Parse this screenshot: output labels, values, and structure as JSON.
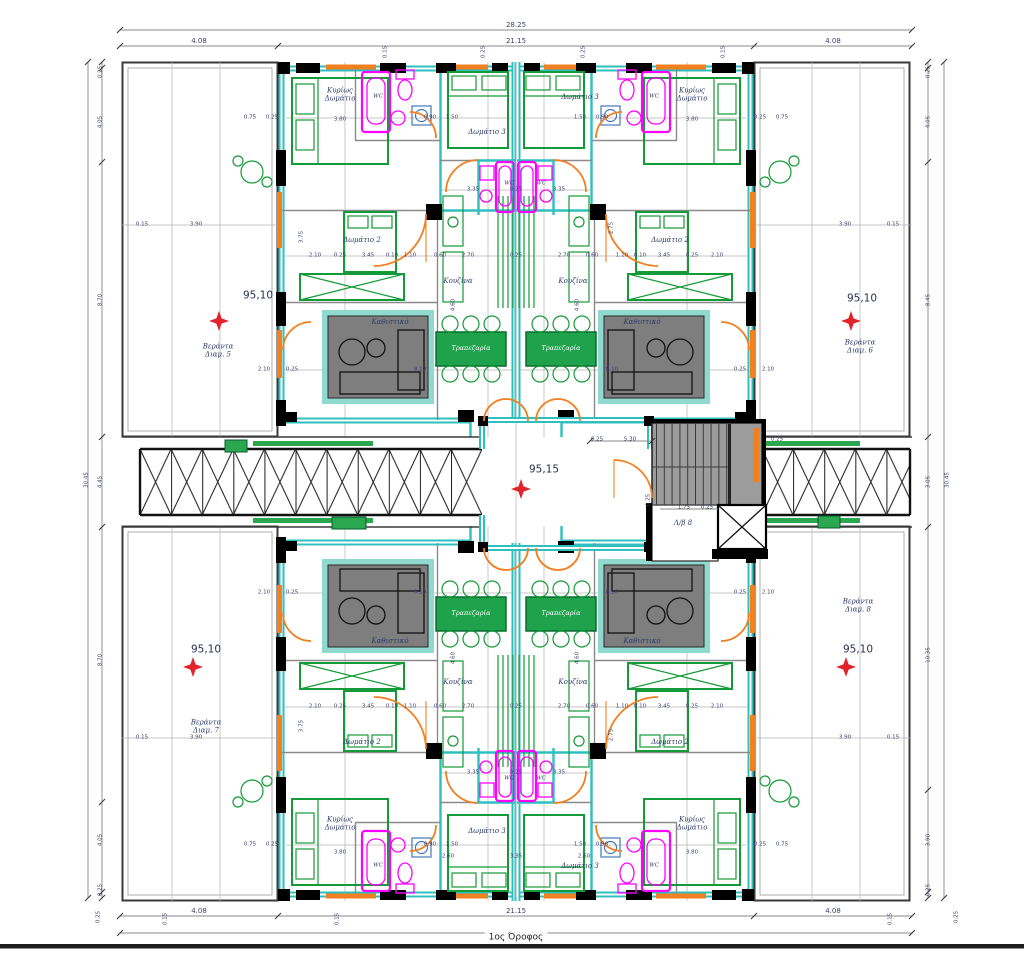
{
  "drawing": {
    "title": "1ος Όροφος"
  },
  "colors": {
    "wall_cyan": "#2FBFBF",
    "furniture_green": "#149A38",
    "dining_fill": "#1FA24C",
    "fixture_magenta": "#FF00FF",
    "door_orange": "#F08020",
    "level_marker_red": "#E3232B",
    "sofa_gray": "#7E7E7E",
    "slab_teal": "#8FD9CE",
    "stair_gray": "#9C9C9C"
  },
  "texts": [
    {
      "t": "95,10",
      "x": 258,
      "y": 296,
      "c": "level"
    },
    {
      "t": "95,10",
      "x": 862,
      "y": 299,
      "c": "level"
    },
    {
      "t": "95,10",
      "x": 206,
      "y": 650,
      "c": "level"
    },
    {
      "t": "95,10",
      "x": 858,
      "y": 650,
      "c": "level"
    },
    {
      "t": "95,15",
      "x": 544,
      "y": 470,
      "c": "level"
    },
    {
      "t": "Κυρίως\nΔωμάτιο",
      "x": 340,
      "y": 95,
      "c": "room"
    },
    {
      "t": "Κυρίως\nΔωμάτιο",
      "x": 692,
      "y": 95,
      "c": "room"
    },
    {
      "t": "Κυρίως\nΔωμάτιο",
      "x": 340,
      "y": 824,
      "c": "room"
    },
    {
      "t": "Κυρίως\nΔωμάτιο",
      "x": 692,
      "y": 824,
      "c": "room"
    },
    {
      "t": "Δωμάτιο 2",
      "x": 362,
      "y": 240,
      "c": "room"
    },
    {
      "t": "Δωμάτιο 2",
      "x": 670,
      "y": 240,
      "c": "room"
    },
    {
      "t": "Δωμάτιο 2",
      "x": 362,
      "y": 742,
      "c": "room"
    },
    {
      "t": "Δωμάτιο 2",
      "x": 670,
      "y": 742,
      "c": "room"
    },
    {
      "t": "Δωμάτιο 3",
      "x": 487,
      "y": 132,
      "c": "room"
    },
    {
      "t": "Δωμάτιο 3",
      "x": 580,
      "y": 97,
      "c": "room"
    },
    {
      "t": "Δωμάτιο 3",
      "x": 487,
      "y": 831,
      "c": "room"
    },
    {
      "t": "Δωμάτιο 3",
      "x": 580,
      "y": 866,
      "c": "room"
    },
    {
      "t": "Κουζίνα",
      "x": 458,
      "y": 281,
      "c": "room"
    },
    {
      "t": "Κουζίνα",
      "x": 573,
      "y": 281,
      "c": "room"
    },
    {
      "t": "Κουζίνα",
      "x": 458,
      "y": 682,
      "c": "room"
    },
    {
      "t": "Κουζίνα",
      "x": 573,
      "y": 682,
      "c": "room"
    },
    {
      "t": "Καθιστικό",
      "x": 390,
      "y": 322,
      "c": "room"
    },
    {
      "t": "Καθιστικό",
      "x": 642,
      "y": 322,
      "c": "room"
    },
    {
      "t": "Καθιστικό",
      "x": 390,
      "y": 641,
      "c": "room"
    },
    {
      "t": "Καθιστικό",
      "x": 642,
      "y": 641,
      "c": "room"
    },
    {
      "t": "Βεράντα\nΔιαμ. 5",
      "x": 218,
      "y": 351,
      "c": "room"
    },
    {
      "t": "Βεράντα\nΔιαμ. 6",
      "x": 860,
      "y": 347,
      "c": "room"
    },
    {
      "t": "Βεράντα\nΔιαμ. 7",
      "x": 206,
      "y": 727,
      "c": "room"
    },
    {
      "t": "Βεράντα\nΔιαμ. 8",
      "x": 858,
      "y": 606,
      "c": "room"
    },
    {
      "t": "Λ/β 8",
      "x": 683,
      "y": 523,
      "c": "room"
    },
    {
      "t": "Τραπεζαρία",
      "x": 471,
      "y": 349,
      "c": "dining"
    },
    {
      "t": "Τραπεζαρία",
      "x": 561,
      "y": 349,
      "c": "dining"
    },
    {
      "t": "Τραπεζαρία",
      "x": 471,
      "y": 614,
      "c": "dining"
    },
    {
      "t": "Τραπεζαρία",
      "x": 561,
      "y": 614,
      "c": "dining"
    },
    {
      "t": "WC",
      "x": 509,
      "y": 184,
      "c": "wc"
    },
    {
      "t": "WC",
      "x": 541,
      "y": 184,
      "c": "wc"
    },
    {
      "t": "WC",
      "x": 509,
      "y": 779,
      "c": "wc"
    },
    {
      "t": "WC",
      "x": 541,
      "y": 779,
      "c": "wc"
    },
    {
      "t": "WC",
      "x": 378,
      "y": 97,
      "c": "wc"
    },
    {
      "t": "WC",
      "x": 654,
      "y": 97,
      "c": "wc"
    },
    {
      "t": "WC",
      "x": 378,
      "y": 866,
      "c": "wc"
    },
    {
      "t": "WC",
      "x": 654,
      "y": 866,
      "c": "wc"
    },
    {
      "t": "28.25",
      "x": 516,
      "y": 25,
      "c": "dimL"
    },
    {
      "t": "4.08",
      "x": 199,
      "y": 41,
      "c": "dimL"
    },
    {
      "t": "21.15",
      "x": 516,
      "y": 41,
      "c": "dimL"
    },
    {
      "t": "4.08",
      "x": 833,
      "y": 41,
      "c": "dimL"
    },
    {
      "t": "4.08",
      "x": 199,
      "y": 911,
      "c": "dimL"
    },
    {
      "t": "21.15",
      "x": 516,
      "y": 911,
      "c": "dimL"
    },
    {
      "t": "4.08",
      "x": 833,
      "y": 911,
      "c": "dimL"
    },
    {
      "t": "30.45",
      "x": 87,
      "y": 480,
      "c": "dim",
      "r": 1
    },
    {
      "t": "0.25",
      "x": 101,
      "y": 72,
      "c": "dim",
      "r": 1
    },
    {
      "t": "4.05",
      "x": 101,
      "y": 122,
      "c": "dim",
      "r": 1
    },
    {
      "t": "8.70",
      "x": 101,
      "y": 300,
      "c": "dim",
      "r": 1
    },
    {
      "t": "4.45",
      "x": 101,
      "y": 482,
      "c": "dim",
      "r": 1
    },
    {
      "t": "8.70",
      "x": 101,
      "y": 660,
      "c": "dim",
      "r": 1
    },
    {
      "t": "4.05",
      "x": 101,
      "y": 840,
      "c": "dim",
      "r": 1
    },
    {
      "t": "0.25",
      "x": 101,
      "y": 890,
      "c": "dim",
      "r": 1
    },
    {
      "t": "30.45",
      "x": 948,
      "y": 480,
      "c": "dim",
      "r": 1
    },
    {
      "t": "0.25",
      "x": 929,
      "y": 72,
      "c": "dim",
      "r": 1
    },
    {
      "t": "4.05",
      "x": 929,
      "y": 122,
      "c": "dim",
      "r": 1
    },
    {
      "t": "8.45",
      "x": 929,
      "y": 300,
      "c": "dim",
      "r": 1
    },
    {
      "t": "3.05",
      "x": 929,
      "y": 482,
      "c": "dim",
      "r": 1
    },
    {
      "t": "10.35",
      "x": 929,
      "y": 655,
      "c": "dim",
      "r": 1
    },
    {
      "t": "3.90",
      "x": 929,
      "y": 840,
      "c": "dim",
      "r": 1
    },
    {
      "t": "0.25",
      "x": 929,
      "y": 890,
      "c": "dim",
      "r": 1
    },
    {
      "t": "0.15",
      "x": 386,
      "y": 52,
      "c": "dim",
      "r": 1
    },
    {
      "t": "0.25",
      "x": 484,
      "y": 52,
      "c": "dim",
      "r": 1
    },
    {
      "t": "0.25",
      "x": 584,
      "y": 52,
      "c": "dim",
      "r": 1
    },
    {
      "t": "0.15",
      "x": 724,
      "y": 52,
      "c": "dim",
      "r": 1
    },
    {
      "t": "0.25",
      "x": 99,
      "y": 917,
      "c": "dim",
      "r": 1
    },
    {
      "t": "0.15",
      "x": 166,
      "y": 919,
      "c": "dim",
      "r": 1
    },
    {
      "t": "0.15",
      "x": 338,
      "y": 919,
      "c": "dim",
      "r": 1
    },
    {
      "t": "0.15",
      "x": 891,
      "y": 919,
      "c": "dim",
      "r": 1
    },
    {
      "t": "0.25",
      "x": 957,
      "y": 917,
      "c": "dim",
      "r": 1
    },
    {
      "t": "4.60",
      "x": 578,
      "y": 305,
      "c": "dim",
      "r": 1
    },
    {
      "t": "4.60",
      "x": 454,
      "y": 305,
      "c": "dim",
      "r": 1
    },
    {
      "t": "4.60",
      "x": 578,
      "y": 658,
      "c": "dim",
      "r": 1
    },
    {
      "t": "4.60",
      "x": 454,
      "y": 658,
      "c": "dim",
      "r": 1
    },
    {
      "t": "3.75",
      "x": 302,
      "y": 237,
      "c": "dim",
      "r": 1
    },
    {
      "t": "2.75",
      "x": 612,
      "y": 228,
      "c": "dim",
      "r": 1
    },
    {
      "t": "3.75",
      "x": 302,
      "y": 726,
      "c": "dim",
      "r": 1
    },
    {
      "t": "2.75",
      "x": 612,
      "y": 735,
      "c": "dim",
      "r": 1
    },
    {
      "t": "0.25",
      "x": 649,
      "y": 500,
      "c": "dim",
      "r": 1
    },
    {
      "t": "3.80",
      "x": 340,
      "y": 120,
      "c": "dim"
    },
    {
      "t": "3.80",
      "x": 692,
      "y": 120,
      "c": "dim"
    },
    {
      "t": "3.80",
      "x": 340,
      "y": 853,
      "c": "dim"
    },
    {
      "t": "3.80",
      "x": 692,
      "y": 853,
      "c": "dim"
    },
    {
      "t": "0.75",
      "x": 250,
      "y": 118,
      "c": "dim"
    },
    {
      "t": "0.25",
      "x": 272,
      "y": 118,
      "c": "dim"
    },
    {
      "t": "0.90",
      "x": 430,
      "y": 118,
      "c": "dim"
    },
    {
      "t": "1.50",
      "x": 452,
      "y": 118,
      "c": "dim"
    },
    {
      "t": "1.50",
      "x": 580,
      "y": 118,
      "c": "dim"
    },
    {
      "t": "0.90",
      "x": 602,
      "y": 118,
      "c": "dim"
    },
    {
      "t": "0.25",
      "x": 760,
      "y": 118,
      "c": "dim"
    },
    {
      "t": "0.75",
      "x": 782,
      "y": 118,
      "c": "dim"
    },
    {
      "t": "0.75",
      "x": 250,
      "y": 845,
      "c": "dim"
    },
    {
      "t": "0.25",
      "x": 272,
      "y": 845,
      "c": "dim"
    },
    {
      "t": "0.90",
      "x": 430,
      "y": 845,
      "c": "dim"
    },
    {
      "t": "1.50",
      "x": 452,
      "y": 845,
      "c": "dim"
    },
    {
      "t": "1.50",
      "x": 580,
      "y": 845,
      "c": "dim"
    },
    {
      "t": "0.90",
      "x": 602,
      "y": 845,
      "c": "dim"
    },
    {
      "t": "0.25",
      "x": 760,
      "y": 845,
      "c": "dim"
    },
    {
      "t": "0.75",
      "x": 782,
      "y": 845,
      "c": "dim"
    },
    {
      "t": "2.60",
      "x": 448,
      "y": 857,
      "c": "dim"
    },
    {
      "t": "3.35",
      "x": 516,
      "y": 857,
      "c": "dim"
    },
    {
      "t": "2.60",
      "x": 584,
      "y": 857,
      "c": "dim"
    },
    {
      "t": "3.35",
      "x": 473,
      "y": 190,
      "c": "dim"
    },
    {
      "t": "0.25",
      "x": 516,
      "y": 190,
      "c": "dim"
    },
    {
      "t": "3.35",
      "x": 559,
      "y": 190,
      "c": "dim"
    },
    {
      "t": "3.35",
      "x": 473,
      "y": 773,
      "c": "dim"
    },
    {
      "t": "0.25",
      "x": 516,
      "y": 773,
      "c": "dim"
    },
    {
      "t": "3.35",
      "x": 559,
      "y": 773,
      "c": "dim"
    },
    {
      "t": "0.15",
      "x": 142,
      "y": 225,
      "c": "dim"
    },
    {
      "t": "3.90",
      "x": 196,
      "y": 225,
      "c": "dim"
    },
    {
      "t": "3.90",
      "x": 845,
      "y": 225,
      "c": "dim"
    },
    {
      "t": "0.15",
      "x": 893,
      "y": 225,
      "c": "dim"
    },
    {
      "t": "0.15",
      "x": 142,
      "y": 738,
      "c": "dim"
    },
    {
      "t": "3.90",
      "x": 196,
      "y": 738,
      "c": "dim"
    },
    {
      "t": "3.90",
      "x": 845,
      "y": 738,
      "c": "dim"
    },
    {
      "t": "0.15",
      "x": 893,
      "y": 738,
      "c": "dim"
    },
    {
      "t": "2.10",
      "x": 315,
      "y": 256,
      "c": "dim"
    },
    {
      "t": "0.25",
      "x": 340,
      "y": 256,
      "c": "dim"
    },
    {
      "t": "3.45",
      "x": 368,
      "y": 256,
      "c": "dim"
    },
    {
      "t": "0.10",
      "x": 392,
      "y": 256,
      "c": "dim"
    },
    {
      "t": "1.10",
      "x": 410,
      "y": 256,
      "c": "dim"
    },
    {
      "t": "0.60",
      "x": 440,
      "y": 256,
      "c": "dim"
    },
    {
      "t": "2.70",
      "x": 468,
      "y": 256,
      "c": "dim"
    },
    {
      "t": "0.25",
      "x": 516,
      "y": 256,
      "c": "dim"
    },
    {
      "t": "2.70",
      "x": 564,
      "y": 256,
      "c": "dim"
    },
    {
      "t": "0.60",
      "x": 592,
      "y": 256,
      "c": "dim"
    },
    {
      "t": "1.10",
      "x": 622,
      "y": 256,
      "c": "dim"
    },
    {
      "t": "0.10",
      "x": 640,
      "y": 256,
      "c": "dim"
    },
    {
      "t": "3.45",
      "x": 664,
      "y": 256,
      "c": "dim"
    },
    {
      "t": "0.25",
      "x": 692,
      "y": 256,
      "c": "dim"
    },
    {
      "t": "2.10",
      "x": 717,
      "y": 256,
      "c": "dim"
    },
    {
      "t": "2.10",
      "x": 315,
      "y": 707,
      "c": "dim"
    },
    {
      "t": "0.25",
      "x": 340,
      "y": 707,
      "c": "dim"
    },
    {
      "t": "3.45",
      "x": 368,
      "y": 707,
      "c": "dim"
    },
    {
      "t": "0.10",
      "x": 392,
      "y": 707,
      "c": "dim"
    },
    {
      "t": "1.10",
      "x": 410,
      "y": 707,
      "c": "dim"
    },
    {
      "t": "0.60",
      "x": 440,
      "y": 707,
      "c": "dim"
    },
    {
      "t": "2.70",
      "x": 468,
      "y": 707,
      "c": "dim"
    },
    {
      "t": "0.25",
      "x": 516,
      "y": 707,
      "c": "dim"
    },
    {
      "t": "2.70",
      "x": 564,
      "y": 707,
      "c": "dim"
    },
    {
      "t": "0.60",
      "x": 592,
      "y": 707,
      "c": "dim"
    },
    {
      "t": "1.10",
      "x": 622,
      "y": 707,
      "c": "dim"
    },
    {
      "t": "0.10",
      "x": 640,
      "y": 707,
      "c": "dim"
    },
    {
      "t": "3.45",
      "x": 664,
      "y": 707,
      "c": "dim"
    },
    {
      "t": "0.25",
      "x": 692,
      "y": 707,
      "c": "dim"
    },
    {
      "t": "2.10",
      "x": 717,
      "y": 707,
      "c": "dim"
    },
    {
      "t": "2.10",
      "x": 264,
      "y": 370,
      "c": "dim"
    },
    {
      "t": "0.25",
      "x": 292,
      "y": 370,
      "c": "dim"
    },
    {
      "t": "8.10",
      "x": 420,
      "y": 370,
      "c": "dim"
    },
    {
      "t": "8.10",
      "x": 612,
      "y": 370,
      "c": "dim"
    },
    {
      "t": "0.25",
      "x": 740,
      "y": 370,
      "c": "dim"
    },
    {
      "t": "2.10",
      "x": 768,
      "y": 370,
      "c": "dim"
    },
    {
      "t": "2.10",
      "x": 264,
      "y": 593,
      "c": "dim"
    },
    {
      "t": "0.25",
      "x": 292,
      "y": 593,
      "c": "dim"
    },
    {
      "t": "8.10",
      "x": 420,
      "y": 593,
      "c": "dim"
    },
    {
      "t": "8.10",
      "x": 612,
      "y": 593,
      "c": "dim"
    },
    {
      "t": "0.25",
      "x": 740,
      "y": 593,
      "c": "dim"
    },
    {
      "t": "2.10",
      "x": 768,
      "y": 593,
      "c": "dim"
    },
    {
      "t": "0.25",
      "x": 597,
      "y": 440,
      "c": "dim"
    },
    {
      "t": "5.30",
      "x": 630,
      "y": 440,
      "c": "dim"
    },
    {
      "t": "0.25",
      "x": 777,
      "y": 440,
      "c": "dim"
    },
    {
      "t": "1.75",
      "x": 684,
      "y": 508,
      "c": "dim"
    },
    {
      "t": "0.25",
      "x": 707,
      "y": 508,
      "c": "dim"
    }
  ]
}
